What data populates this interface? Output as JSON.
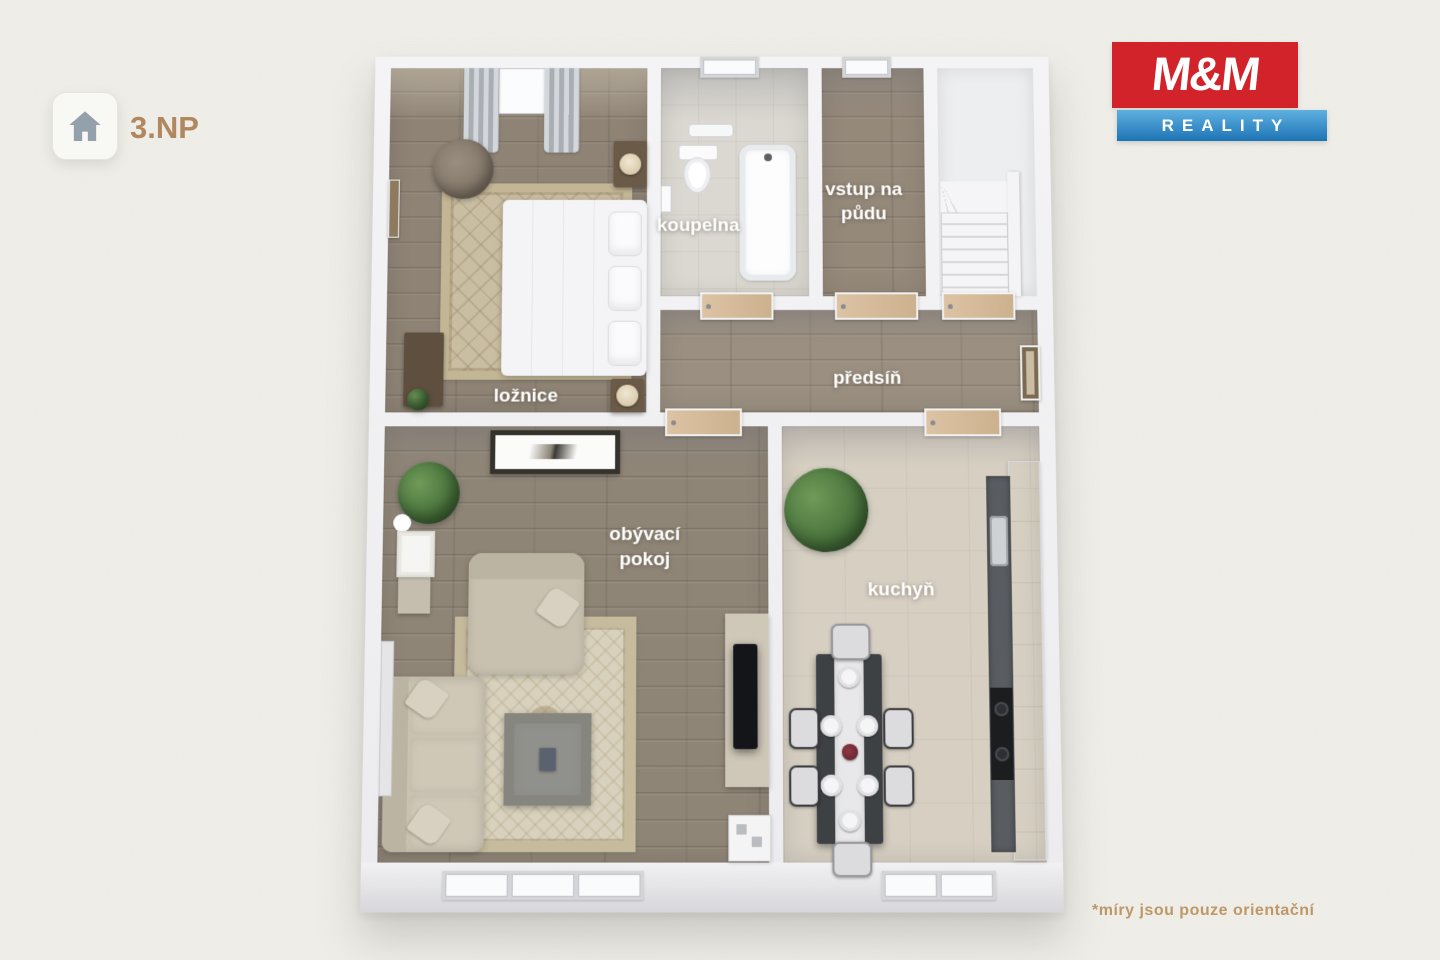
{
  "scene": {
    "background_color": "#f0efe9",
    "accent_text_color": "#b1875f"
  },
  "floor_selector": {
    "icon": "home-icon",
    "label": "3.NP"
  },
  "logo": {
    "title": "M&M",
    "subtitle": "REALITY",
    "title_bg_color": "#d2232a",
    "subtitle_bg_color": "#2b84c4",
    "text_color": "#ffffff"
  },
  "rooms": {
    "loznice": {
      "label": "ložnice"
    },
    "koupelna": {
      "label": "koupelna"
    },
    "vstup": {
      "label": "vstup na půdu"
    },
    "predsin": {
      "label": "předsíň"
    },
    "obyvaci": {
      "label": "obývací pokoj"
    },
    "kuchyn": {
      "label": "kuchyň"
    }
  },
  "footnote": {
    "text": "*míry jsou pouze orientační",
    "color": "#bf9868"
  }
}
